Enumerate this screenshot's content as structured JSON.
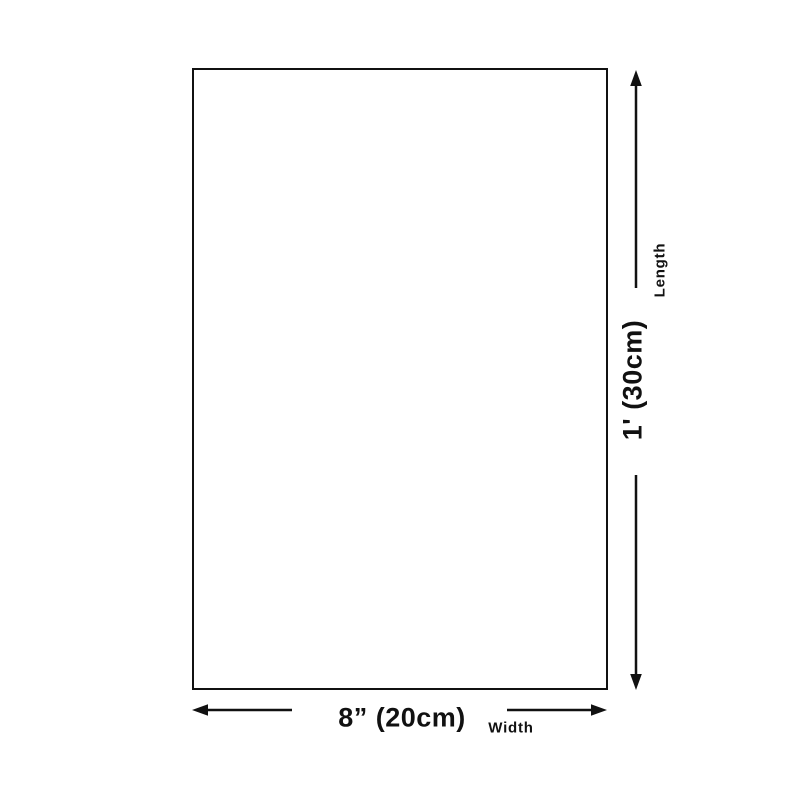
{
  "diagram": {
    "length": {
      "value": "1' (30cm)",
      "label": "Length"
    },
    "width": {
      "value": "8” (20cm)",
      "label": "Width"
    },
    "colors": {
      "ink": "#111111",
      "background": "#ffffff"
    }
  }
}
